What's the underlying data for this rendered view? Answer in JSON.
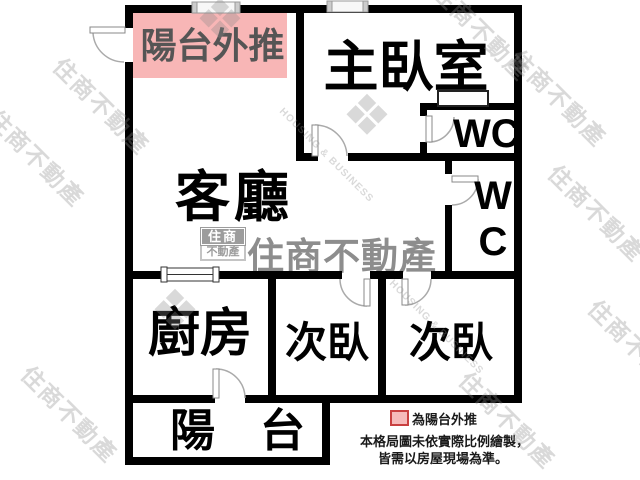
{
  "rooms": {
    "balcony_pushout": "陽台外推",
    "master_bedroom": "主臥室",
    "wc_upper": "WC",
    "wc_lower_line1": "W",
    "wc_lower_line2": "C",
    "living_room": "客廳",
    "kitchen": "廚房",
    "bedroom_left": "次臥",
    "bedroom_right": "次臥",
    "balcony": "陽　台"
  },
  "legend": {
    "swatch_label": "為陽台外推",
    "disclaimer_line1": "本格局圖未依實際比例繪製，",
    "disclaimer_line2": "皆需以房屋現場為準。"
  },
  "watermarks": {
    "brand_name": "住商不動產",
    "brand_name_en": "HOUSING & BUSINESS",
    "logo_top": "住商",
    "logo_bottom": "不動產"
  },
  "colors": {
    "pushout_fill": "#f8b6b6",
    "legend_swatch_fill": "#f6baba",
    "legend_swatch_border": "#c94040",
    "wall": "#000000",
    "pushout_text": "#555555",
    "watermark_gray": "#8d8d8d"
  }
}
